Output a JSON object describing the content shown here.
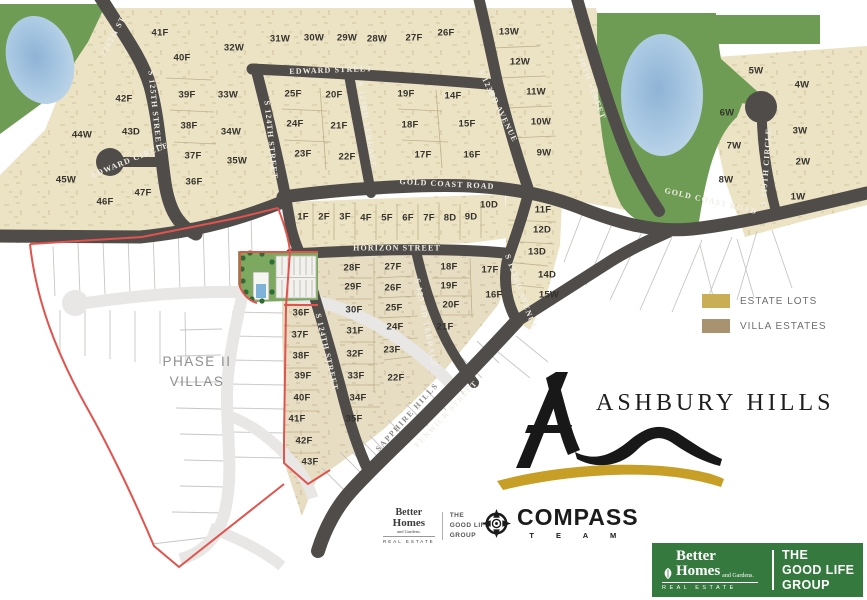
{
  "map": {
    "lots": [
      {
        "label": "41F",
        "x": 160,
        "y": 33
      },
      {
        "label": "40F",
        "x": 182,
        "y": 58
      },
      {
        "label": "42F",
        "x": 124,
        "y": 99
      },
      {
        "label": "43D",
        "x": 131,
        "y": 132
      },
      {
        "label": "44W",
        "x": 82,
        "y": 135
      },
      {
        "label": "45W",
        "x": 66,
        "y": 180
      },
      {
        "label": "46F",
        "x": 105,
        "y": 202
      },
      {
        "label": "47F",
        "x": 143,
        "y": 193
      },
      {
        "label": "39F",
        "x": 187,
        "y": 95
      },
      {
        "label": "38F",
        "x": 189,
        "y": 126
      },
      {
        "label": "37F",
        "x": 193,
        "y": 156
      },
      {
        "label": "36F",
        "x": 194,
        "y": 182
      },
      {
        "label": "32W",
        "x": 234,
        "y": 48
      },
      {
        "label": "33W",
        "x": 228,
        "y": 95
      },
      {
        "label": "34W",
        "x": 231,
        "y": 132
      },
      {
        "label": "35W",
        "x": 237,
        "y": 161
      },
      {
        "label": "31W",
        "x": 280,
        "y": 39
      },
      {
        "label": "30W",
        "x": 314,
        "y": 38
      },
      {
        "label": "29W",
        "x": 347,
        "y": 38
      },
      {
        "label": "28W",
        "x": 377,
        "y": 39
      },
      {
        "label": "27F",
        "x": 414,
        "y": 38
      },
      {
        "label": "26F",
        "x": 446,
        "y": 33
      },
      {
        "label": "25F",
        "x": 293,
        "y": 94
      },
      {
        "label": "24F",
        "x": 295,
        "y": 124
      },
      {
        "label": "23F",
        "x": 303,
        "y": 154
      },
      {
        "label": "20F",
        "x": 334,
        "y": 95
      },
      {
        "label": "21F",
        "x": 339,
        "y": 126
      },
      {
        "label": "22F",
        "x": 347,
        "y": 157
      },
      {
        "label": "19F",
        "x": 406,
        "y": 94
      },
      {
        "label": "18F",
        "x": 410,
        "y": 125
      },
      {
        "label": "17F",
        "x": 423,
        "y": 155
      },
      {
        "label": "14F",
        "x": 453,
        "y": 96
      },
      {
        "label": "15F",
        "x": 467,
        "y": 124
      },
      {
        "label": "16F",
        "x": 472,
        "y": 155
      },
      {
        "label": "13W",
        "x": 509,
        "y": 32
      },
      {
        "label": "12W",
        "x": 520,
        "y": 62
      },
      {
        "label": "11W",
        "x": 536,
        "y": 92
      },
      {
        "label": "10W",
        "x": 541,
        "y": 122
      },
      {
        "label": "9W",
        "x": 544,
        "y": 153
      },
      {
        "label": "5W",
        "x": 756,
        "y": 71
      },
      {
        "label": "4W",
        "x": 802,
        "y": 85
      },
      {
        "label": "6W",
        "x": 727,
        "y": 113
      },
      {
        "label": "3W",
        "x": 800,
        "y": 131
      },
      {
        "label": "7W",
        "x": 734,
        "y": 146
      },
      {
        "label": "2W",
        "x": 803,
        "y": 162
      },
      {
        "label": "8W",
        "x": 726,
        "y": 180
      },
      {
        "label": "1W",
        "x": 798,
        "y": 197
      },
      {
        "label": "1F",
        "x": 303,
        "y": 217
      },
      {
        "label": "2F",
        "x": 324,
        "y": 217
      },
      {
        "label": "3F",
        "x": 345,
        "y": 217
      },
      {
        "label": "4F",
        "x": 366,
        "y": 218
      },
      {
        "label": "5F",
        "x": 387,
        "y": 218
      },
      {
        "label": "6F",
        "x": 408,
        "y": 218
      },
      {
        "label": "7F",
        "x": 429,
        "y": 218
      },
      {
        "label": "8D",
        "x": 450,
        "y": 218
      },
      {
        "label": "9D",
        "x": 471,
        "y": 217
      },
      {
        "label": "10D",
        "x": 489,
        "y": 205
      },
      {
        "label": "11F",
        "x": 543,
        "y": 210
      },
      {
        "label": "12D",
        "x": 542,
        "y": 230
      },
      {
        "label": "13D",
        "x": 537,
        "y": 252
      },
      {
        "label": "14D",
        "x": 547,
        "y": 275
      },
      {
        "label": "15W",
        "x": 549,
        "y": 295
      },
      {
        "label": "28F",
        "x": 352,
        "y": 268
      },
      {
        "label": "27F",
        "x": 393,
        "y": 267
      },
      {
        "label": "29F",
        "x": 353,
        "y": 287
      },
      {
        "label": "26F",
        "x": 393,
        "y": 288
      },
      {
        "label": "30F",
        "x": 354,
        "y": 310
      },
      {
        "label": "25F",
        "x": 394,
        "y": 308
      },
      {
        "label": "31F",
        "x": 355,
        "y": 331
      },
      {
        "label": "24F",
        "x": 395,
        "y": 327
      },
      {
        "label": "32F",
        "x": 355,
        "y": 354
      },
      {
        "label": "23F",
        "x": 392,
        "y": 350
      },
      {
        "label": "33F",
        "x": 356,
        "y": 376
      },
      {
        "label": "22F",
        "x": 396,
        "y": 378
      },
      {
        "label": "34F",
        "x": 358,
        "y": 398
      },
      {
        "label": "35F",
        "x": 354,
        "y": 419
      },
      {
        "label": "18F",
        "x": 449,
        "y": 267
      },
      {
        "label": "17F",
        "x": 490,
        "y": 270
      },
      {
        "label": "19F",
        "x": 449,
        "y": 286
      },
      {
        "label": "16F",
        "x": 494,
        "y": 295
      },
      {
        "label": "20F",
        "x": 451,
        "y": 305
      },
      {
        "label": "21F",
        "x": 445,
        "y": 327
      },
      {
        "label": "36F",
        "x": 301,
        "y": 313
      },
      {
        "label": "37F",
        "x": 300,
        "y": 335
      },
      {
        "label": "38F",
        "x": 301,
        "y": 356
      },
      {
        "label": "39F",
        "x": 303,
        "y": 376
      },
      {
        "label": "40F",
        "x": 302,
        "y": 398
      },
      {
        "label": "41F",
        "x": 297,
        "y": 419
      },
      {
        "label": "42F",
        "x": 304,
        "y": 441
      },
      {
        "label": "43F",
        "x": 310,
        "y": 462
      }
    ],
    "street_labels": [
      {
        "name": "126TH ST",
        "x": 113,
        "y": 36,
        "rot": -62
      },
      {
        "name": "S 125TH STREET",
        "x": 155,
        "y": 110,
        "rot": 84
      },
      {
        "name": "EDWARD CIRCLE",
        "x": 130,
        "y": 160,
        "rot": -22
      },
      {
        "name": "EDWARD STREET",
        "x": 331,
        "y": 70,
        "rot": -2
      },
      {
        "name": "S 124TH STREET",
        "x": 271,
        "y": 140,
        "rot": 84
      },
      {
        "name": "S 123RD TERRACE",
        "x": 367,
        "y": 125,
        "rot": 81
      },
      {
        "name": "S 123RD AVENUE",
        "x": 498,
        "y": 106,
        "rot": 64
      },
      {
        "name": "S 120TH STREET",
        "x": 590,
        "y": 82,
        "rot": 70
      },
      {
        "name": "S 119TH CIRCLE",
        "x": 766,
        "y": 167,
        "rot": -86
      },
      {
        "name": "GOLD COAST ROAD",
        "x": 447,
        "y": 184,
        "rot": 3
      },
      {
        "name": "GOLD COAST ROAD",
        "x": 711,
        "y": 201,
        "rot": 13
      },
      {
        "name": "HORIZON STREET",
        "x": 397,
        "y": 248,
        "rot": 0
      },
      {
        "name": "S 124TH STREET",
        "x": 327,
        "y": 352,
        "rot": 77
      },
      {
        "name": "S 123 RD TERRACE",
        "x": 426,
        "y": 323,
        "rot": 79
      },
      {
        "name": "S 123RD AVENUE",
        "x": 521,
        "y": 292,
        "rot": 70
      },
      {
        "name": "FENWICK STREET",
        "x": 446,
        "y": 414,
        "rot": -47
      },
      {
        "name": "SAPPHIRE HILLS",
        "x": 407,
        "y": 417,
        "rot": -48,
        "variant": "dark"
      }
    ],
    "area_labels": {
      "phase2_line1": "PHASE II",
      "phase2_line2": "VILLAS"
    }
  },
  "legend": {
    "items": [
      {
        "label": "ESTATE LOTS",
        "color": "#c9ae56"
      },
      {
        "label": "VILLA ESTATES",
        "color": "#a8926f"
      }
    ]
  },
  "branding": {
    "ashbury": {
      "title": "ASHBURY HILLS"
    },
    "compass": {
      "name": "COMPASS",
      "team": "T E A M"
    },
    "bhg_small": {
      "line1": "Better",
      "line2": "Homes",
      "line3": "and Gardens.",
      "line4": "REAL ESTATE",
      "group1": "THE",
      "group2": "GOOD LIFE",
      "group3": "GROUP"
    },
    "footer": {
      "brand1": "Better",
      "brand2": "Homes",
      "brand3": "and Gardens.",
      "brand4": "REAL ESTATE",
      "group1": "THE",
      "group2": "GOOD LIFE",
      "group3": "GROUP"
    }
  },
  "colors": {
    "footer_green": "#36793f",
    "road": "#4f4c49",
    "red_boundary": "#e2534d"
  }
}
